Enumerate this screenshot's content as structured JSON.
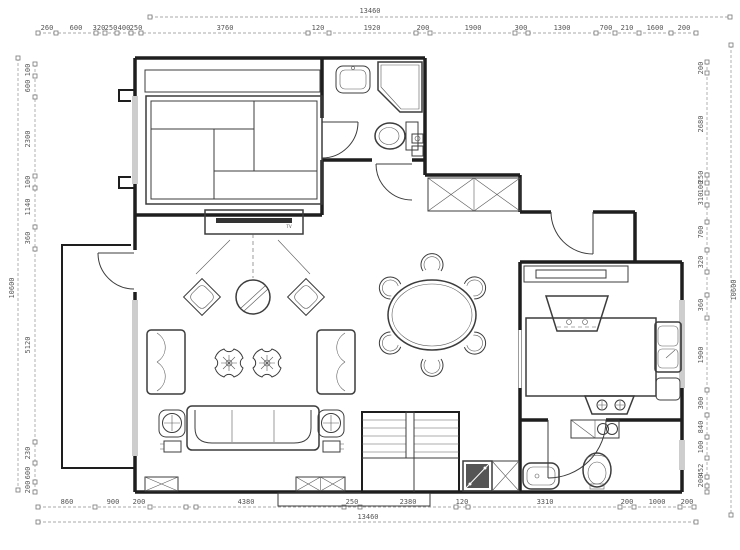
{
  "colors": {
    "background": "#ffffff",
    "wall": "#1e1e1e",
    "furniture": "#3c3c3c",
    "dimension": "#8f8f8f",
    "dimtext": "#555555"
  },
  "labels": {
    "tv": "TV"
  },
  "dimensions": {
    "overall_top": "13460",
    "overall_bottom": "13460",
    "overall_left": "10600",
    "overall_right": "10600",
    "top_labels": [
      {
        "t": "260",
        "x": 47,
        "y": 30
      },
      {
        "t": "600",
        "x": 76,
        "y": 30
      },
      {
        "t": "320",
        "x": 99,
        "y": 30
      },
      {
        "t": "250",
        "x": 111,
        "y": 30
      },
      {
        "t": "400",
        "x": 124,
        "y": 30
      },
      {
        "t": "250",
        "x": 136,
        "y": 30
      },
      {
        "t": "3760",
        "x": 225,
        "y": 30
      },
      {
        "t": "120",
        "x": 318,
        "y": 30
      },
      {
        "t": "1920",
        "x": 372,
        "y": 30
      },
      {
        "t": "200",
        "x": 423,
        "y": 30
      },
      {
        "t": "1900",
        "x": 473,
        "y": 30
      },
      {
        "t": "300",
        "x": 521,
        "y": 30
      },
      {
        "t": "1300",
        "x": 562,
        "y": 30
      },
      {
        "t": "700",
        "x": 606,
        "y": 30
      },
      {
        "t": "210",
        "x": 627,
        "y": 30
      },
      {
        "t": "1600",
        "x": 655,
        "y": 30
      },
      {
        "t": "200",
        "x": 684,
        "y": 30
      }
    ],
    "top_ticks": {
      "axis": "x",
      "fixed": 33,
      "pos": [
        38,
        56,
        96,
        105,
        117,
        131,
        141,
        308,
        329,
        416,
        430,
        515,
        528,
        596,
        615,
        639,
        671,
        696
      ]
    },
    "bottom_labels": [
      {
        "t": "860",
        "x": 67,
        "y": 504
      },
      {
        "t": "900",
        "x": 113,
        "y": 504
      },
      {
        "t": "200",
        "x": 139,
        "y": 504
      },
      {
        "t": "4380",
        "x": 246,
        "y": 504
      },
      {
        "t": "250",
        "x": 352,
        "y": 504
      },
      {
        "t": "2380",
        "x": 408,
        "y": 504
      },
      {
        "t": "120",
        "x": 462,
        "y": 504
      },
      {
        "t": "3310",
        "x": 545,
        "y": 504
      },
      {
        "t": "200",
        "x": 627,
        "y": 504
      },
      {
        "t": "1000",
        "x": 657,
        "y": 504
      },
      {
        "t": "200",
        "x": 687,
        "y": 504
      }
    ],
    "bottom_ticks": {
      "axis": "x",
      "fixed": 507,
      "pos": [
        38,
        95,
        150,
        186,
        196,
        344,
        360,
        456,
        468,
        620,
        634,
        680,
        694
      ]
    },
    "left_labels": [
      {
        "t": "100",
        "x": 30,
        "y": 70,
        "r": -90
      },
      {
        "t": "600",
        "x": 30,
        "y": 86,
        "r": -90
      },
      {
        "t": "2300",
        "x": 30,
        "y": 139,
        "r": -90
      },
      {
        "t": "100",
        "x": 30,
        "y": 182,
        "r": -90
      },
      {
        "t": "1140",
        "x": 30,
        "y": 207,
        "r": -90
      },
      {
        "t": "360",
        "x": 30,
        "y": 238,
        "r": -90
      },
      {
        "t": "5120",
        "x": 30,
        "y": 345,
        "r": -90
      },
      {
        "t": "230",
        "x": 30,
        "y": 453,
        "r": -90
      },
      {
        "t": "600",
        "x": 30,
        "y": 473,
        "r": -90
      },
      {
        "t": "200",
        "x": 30,
        "y": 487,
        "r": -90
      }
    ],
    "left_ticks": {
      "axis": "y",
      "fixed": 35,
      "pos": [
        64,
        76,
        97,
        176,
        188,
        227,
        249,
        442,
        463,
        482,
        492
      ]
    },
    "right_labels": [
      {
        "t": "200",
        "x": 703,
        "y": 68,
        "r": -90
      },
      {
        "t": "2680",
        "x": 703,
        "y": 124,
        "r": -90
      },
      {
        "t": "250",
        "x": 703,
        "y": 177,
        "r": -90
      },
      {
        "t": "100",
        "x": 703,
        "y": 187,
        "r": -90
      },
      {
        "t": "310",
        "x": 703,
        "y": 199,
        "r": -90
      },
      {
        "t": "700",
        "x": 703,
        "y": 232,
        "r": -90
      },
      {
        "t": "320",
        "x": 703,
        "y": 262,
        "r": -90
      },
      {
        "t": "360",
        "x": 703,
        "y": 305,
        "r": -90
      },
      {
        "t": "1900",
        "x": 703,
        "y": 355,
        "r": -90
      },
      {
        "t": "300",
        "x": 703,
        "y": 403,
        "r": -90
      },
      {
        "t": "840",
        "x": 703,
        "y": 427,
        "r": -90
      },
      {
        "t": "100",
        "x": 703,
        "y": 447,
        "r": -90
      },
      {
        "t": "452",
        "x": 703,
        "y": 470,
        "r": -90
      },
      {
        "t": "200",
        "x": 703,
        "y": 481,
        "r": -90
      }
    ],
    "right_ticks": {
      "axis": "y",
      "fixed": 707,
      "pos": [
        62,
        73,
        175,
        183,
        193,
        205,
        222,
        250,
        272,
        295,
        318,
        390,
        415,
        437,
        458,
        477,
        486,
        492
      ]
    },
    "overall_ticks_top": {
      "axis": "x",
      "fixed": 17,
      "pos": [
        150,
        730
      ]
    },
    "overall_ticks_bottom": {
      "axis": "x",
      "fixed": 522,
      "pos": [
        38,
        696
      ]
    },
    "overall_ticks_left": {
      "axis": "y",
      "fixed": 18,
      "pos": [
        58,
        490
      ]
    },
    "overall_ticks_right": {
      "axis": "y",
      "fixed": 731,
      "pos": [
        45,
        515
      ]
    }
  }
}
